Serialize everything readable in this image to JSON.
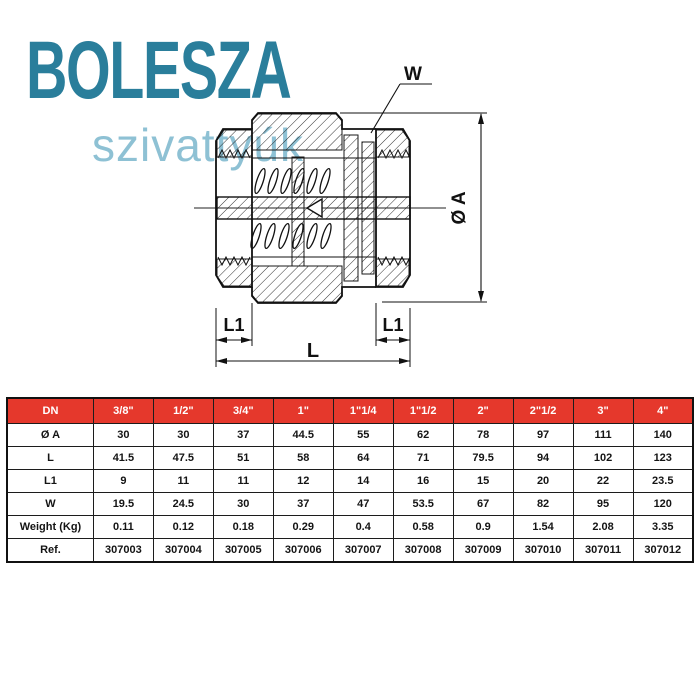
{
  "logo": {
    "brand": "BOLESZA",
    "subtitle": "szivattyúk",
    "brand_color": "#2a7e9b",
    "subtitle_color": "#8ec1d4"
  },
  "drawing": {
    "description": "spring check valve cross-section",
    "labels": {
      "w": "W",
      "dia_a": "Ø A",
      "l1_left": "L1",
      "l1_right": "L1",
      "l": "L"
    }
  },
  "table": {
    "header_bg": "#e5382c",
    "header_text_color": "#ffffff",
    "header": [
      "DN",
      "3/8\"",
      "1/2\"",
      "3/4\"",
      "1\"",
      "1\"1/4",
      "1\"1/2",
      "2\"",
      "2\"1/2",
      "3\"",
      "4\""
    ],
    "rows": [
      {
        "label": "Ø A",
        "values": [
          "30",
          "30",
          "37",
          "44.5",
          "55",
          "62",
          "78",
          "97",
          "111",
          "140"
        ]
      },
      {
        "label": "L",
        "values": [
          "41.5",
          "47.5",
          "51",
          "58",
          "64",
          "71",
          "79.5",
          "94",
          "102",
          "123"
        ]
      },
      {
        "label": "L1",
        "values": [
          "9",
          "11",
          "11",
          "12",
          "14",
          "16",
          "15",
          "20",
          "22",
          "23.5"
        ]
      },
      {
        "label": "W",
        "values": [
          "19.5",
          "24.5",
          "30",
          "37",
          "47",
          "53.5",
          "67",
          "82",
          "95",
          "120"
        ]
      },
      {
        "label": "Weight (Kg)",
        "values": [
          "0.11",
          "0.12",
          "0.18",
          "0.29",
          "0.4",
          "0.58",
          "0.9",
          "1.54",
          "2.08",
          "3.35"
        ]
      },
      {
        "label": "Ref.",
        "values": [
          "307003",
          "307004",
          "307005",
          "307006",
          "307007",
          "307008",
          "307009",
          "307010",
          "307011",
          "307012"
        ]
      }
    ]
  }
}
